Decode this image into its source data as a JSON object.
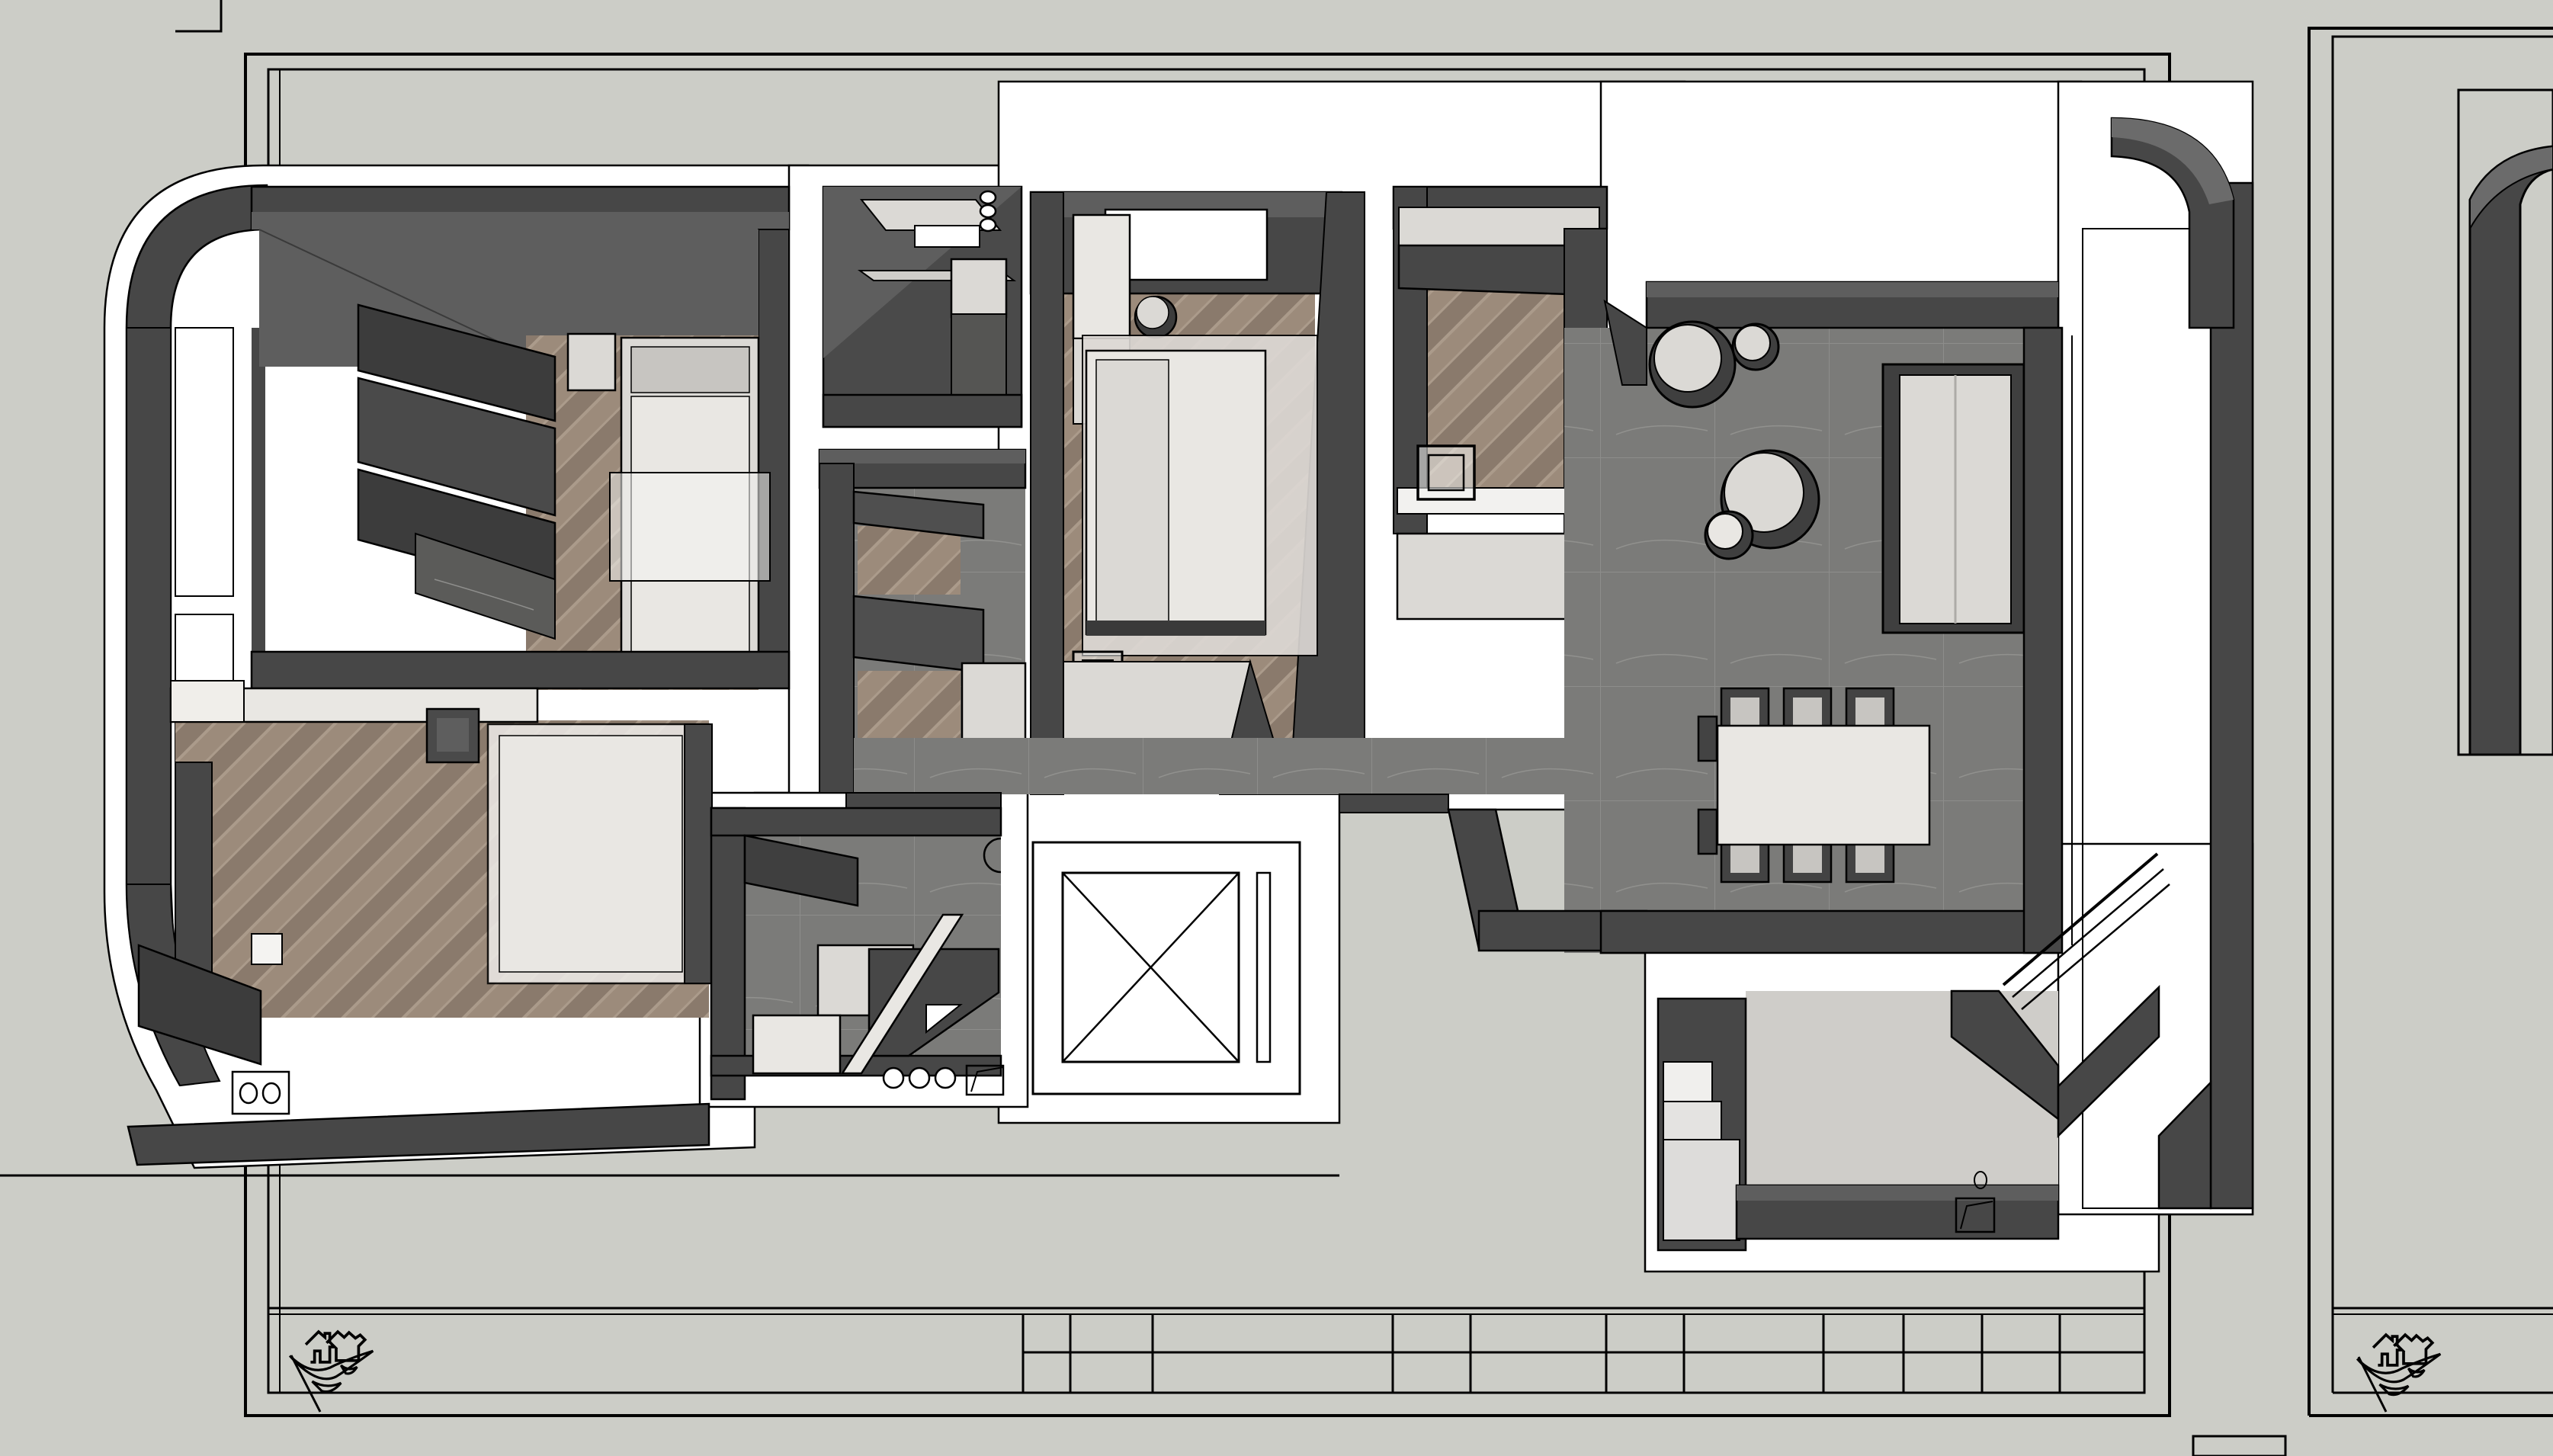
{
  "document": {
    "kind": "floor-plan-render",
    "visible_text": "",
    "sheets": [
      {
        "name": "sheet-left",
        "title_block_rows": 2,
        "title_block_cells_visible": 11,
        "logo": "house-swoosh-stamp"
      },
      {
        "name": "sheet-right",
        "partially_visible": true,
        "logo": "house-swoosh-stamp"
      }
    ],
    "symbols": [
      "house-swoosh-stamp",
      "elevator-cross-box",
      "folded-paper-marker",
      "drain-circle-pair",
      "hook-circle-triplet"
    ]
  },
  "colors": {
    "canvas": "#cccdc7",
    "paper": "#ffffff",
    "outline": "#000000",
    "wall": "#474747",
    "wallDeep": "#3c3c3c",
    "wallTop": "#5e5e5e",
    "wallFace": "#6b6b6b",
    "furnLight": "#dbd9d5",
    "furnLighter": "#e9e7e3",
    "furnMid": "#c7c5c1",
    "tile": "#7b7b79",
    "tileLine": "#8d8d8b",
    "woodA": "#9c8b7b",
    "woodB": "#8a7a6c",
    "woodC": "#ab9b8b",
    "balcony": "#c9ccc2",
    "balconyLine": "#b8bbb1",
    "marble": "#5b5b59",
    "glass": "rgba(244,244,242,0.55)"
  },
  "icons": {
    "logo": "house-swoosh-stamp",
    "elevator": "elevator-cross-box",
    "paper_marker": "folded-paper-marker"
  }
}
